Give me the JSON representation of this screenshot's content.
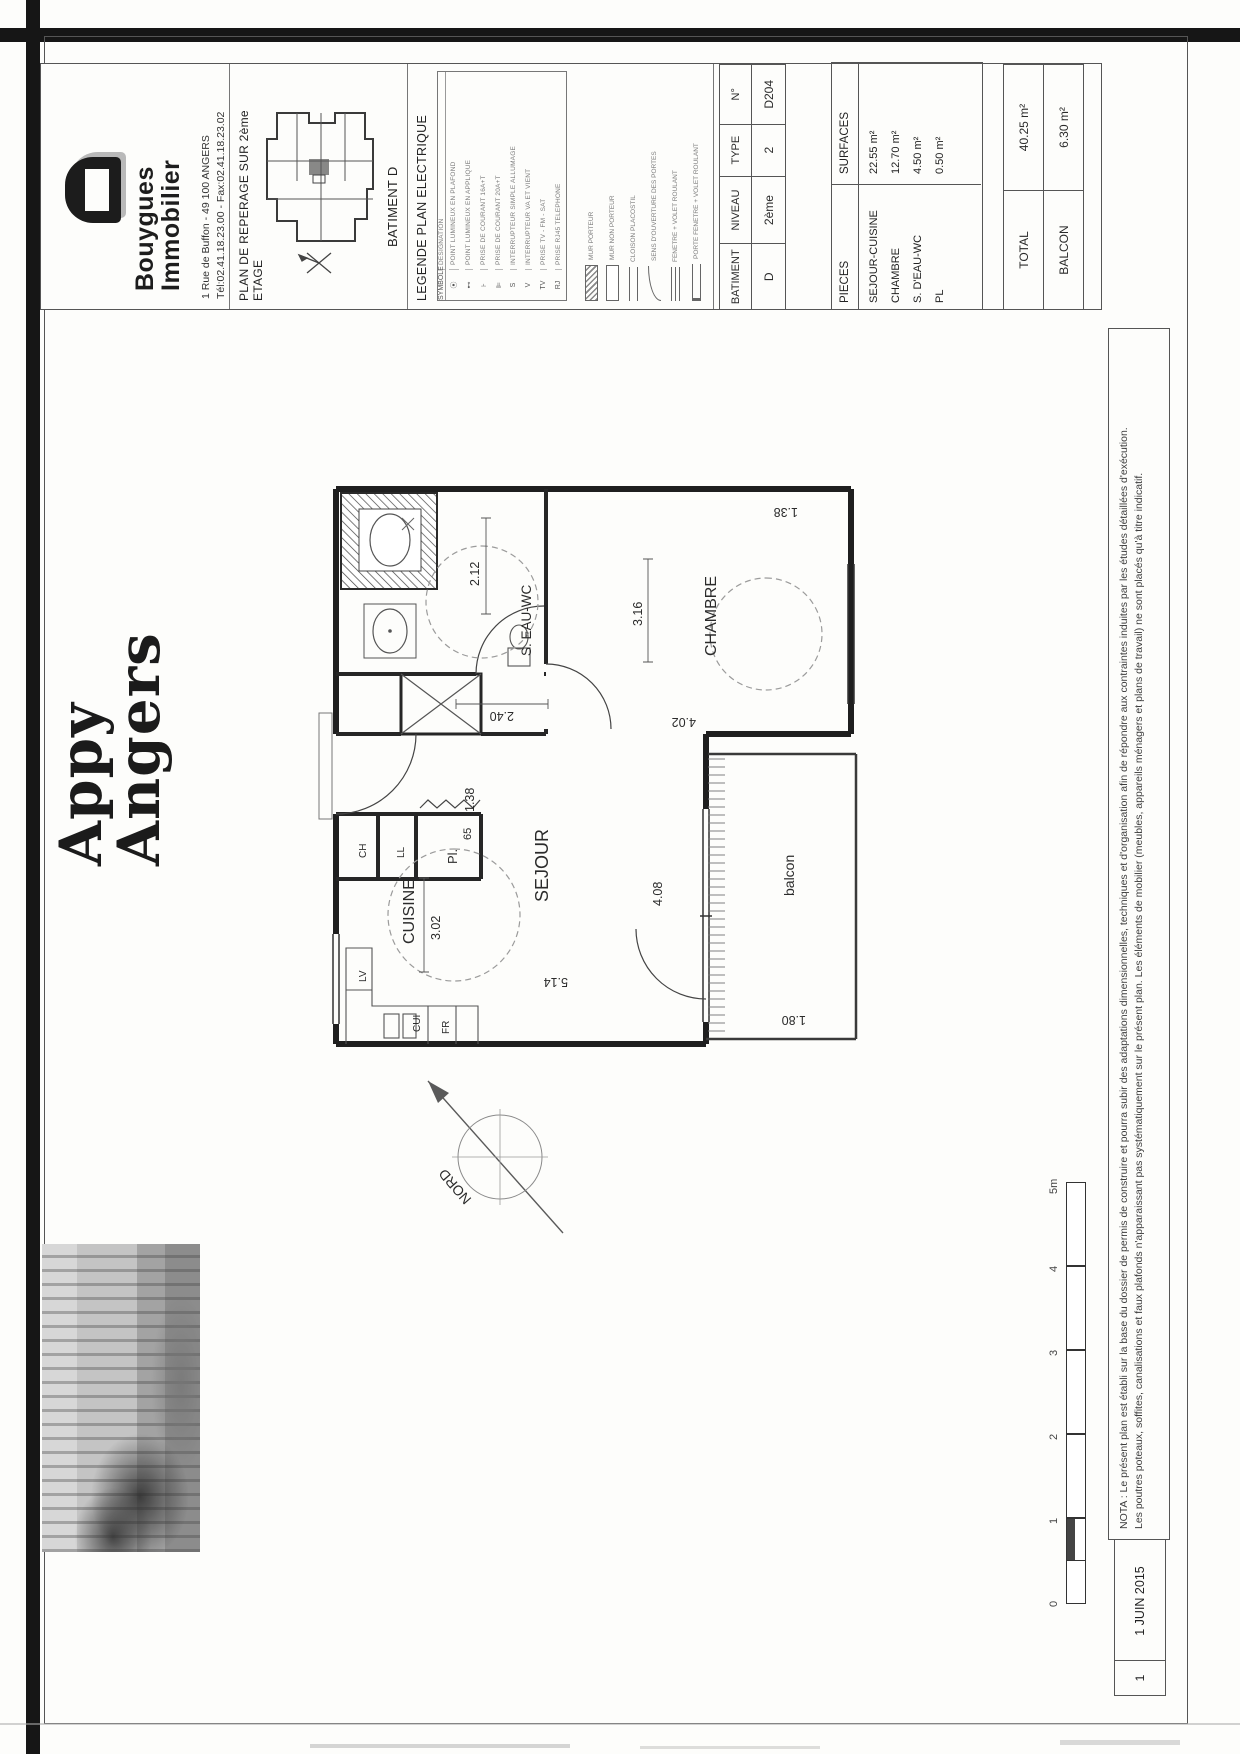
{
  "sheet": {
    "brand": {
      "name1": "Bouygues",
      "name2": "Immobilier",
      "address": "1 Rue de Buffon - 49 100 ANGERS",
      "phone": "Tél:02.41.18.23.00 - Fax:02.41.18.23.02"
    },
    "reperage": {
      "title": "PLAN DE REPERAGE SUR 2ème ETAGE",
      "batiment": "BATIMENT D"
    },
    "legend": {
      "title": "LEGENDE PLAN ELECTRIQUE",
      "col_sym": "SYMBOLE",
      "col_des": "DESIGNATION",
      "entries": [
        [
          "⦿",
          "POINT LUMINEUX EN PLAFOND"
        ],
        [
          "⊷",
          "POINT LUMINEUX EN APPLIQUE"
        ],
        [
          "⊦",
          "PRISE DE COURANT 16A+T"
        ],
        [
          "⊫",
          "PRISE DE COURANT 20A+T"
        ],
        [
          "S",
          "INTERRUPTEUR SIMPLE ALLUMAGE"
        ],
        [
          "V",
          "INTERRUPTEUR VA ET VIENT"
        ],
        [
          "TV",
          "PRISE TV - FM - SAT"
        ],
        [
          "RJ",
          "PRISE RJ45 TELEPHONE"
        ]
      ],
      "symbols": [
        "MUR PORTEUR",
        "MUR NON PORTEUR",
        "CLOISON PLACOSTIL",
        "SENS D'OUVERTURE DES PORTES",
        "FENETRE + VOLET ROULANT",
        "PORTE FENETRE + VOLET ROULANT"
      ]
    },
    "unit_table": {
      "headers": [
        "BATIMENT",
        "NIVEAU",
        "TYPE",
        "N°"
      ],
      "values": [
        "D",
        "2ème",
        "2",
        "D204"
      ]
    },
    "areas": {
      "col_pieces": "PIECES",
      "col_surfaces": "SURFACES",
      "rows": [
        [
          "SEJOUR-CUISINE",
          "22.55 m²"
        ],
        [
          "CHAMBRE",
          "12.70 m²"
        ],
        [
          "S. D'EAU-WC",
          "4.50 m²"
        ],
        [
          "PL",
          "0.50 m²"
        ]
      ],
      "total_label": "TOTAL",
      "total_value": "40.25 m²",
      "balcon_label": "BALCON",
      "balcon_value": "6.30 m²"
    },
    "project": {
      "line1": "Appy",
      "line2": "Angers"
    },
    "plan": {
      "rooms": {
        "cuisine": "CUISINE",
        "sejour": "SEJOUR",
        "chambre": "CHAMBRE",
        "bain": "S. EAU-WC",
        "balcon": "balcon",
        "placard": "Pl.",
        "placard_dim": "65"
      },
      "fixtures": {
        "lv": "LV",
        "cui": "CUI",
        "fr": "FR",
        "ch": "CH",
        "ll": "LL"
      },
      "dims": {
        "entry": "1.38",
        "bain_w": "2.12",
        "bain_h": "2.40",
        "cuisine_w": "3.02",
        "sejour_h": "5.14",
        "sejour_w": "4.08",
        "chambre_w": "3.16",
        "chambre_h": "4.02",
        "chambre_r": "1.38",
        "balcon_d": "1.80"
      },
      "north": "NORD"
    },
    "scalebar": {
      "t0": "0",
      "t1": "1",
      "t2": "2",
      "t3": "3",
      "t4": "4",
      "t5": "5m"
    },
    "revision": {
      "index": "1",
      "date": "1 JUIN 2015"
    },
    "nota": {
      "l1": "NOTA : Le présent plan est établi sur la base du dossier de permis de construire et pourra subir des adaptations dimensionnelles, techniques et d'organisation afin de répondre aux contraintes induites par les études détaillées d'exécution.",
      "l2": "Les poutres poteaux, soffites, canalisations et faux plafonds n'apparaissant pas systématiquement sur le présent plan. Les éléments de mobilier (meubles, appareils ménagers et plans de travail) ne sont placés qu'à titre indicatif."
    }
  }
}
